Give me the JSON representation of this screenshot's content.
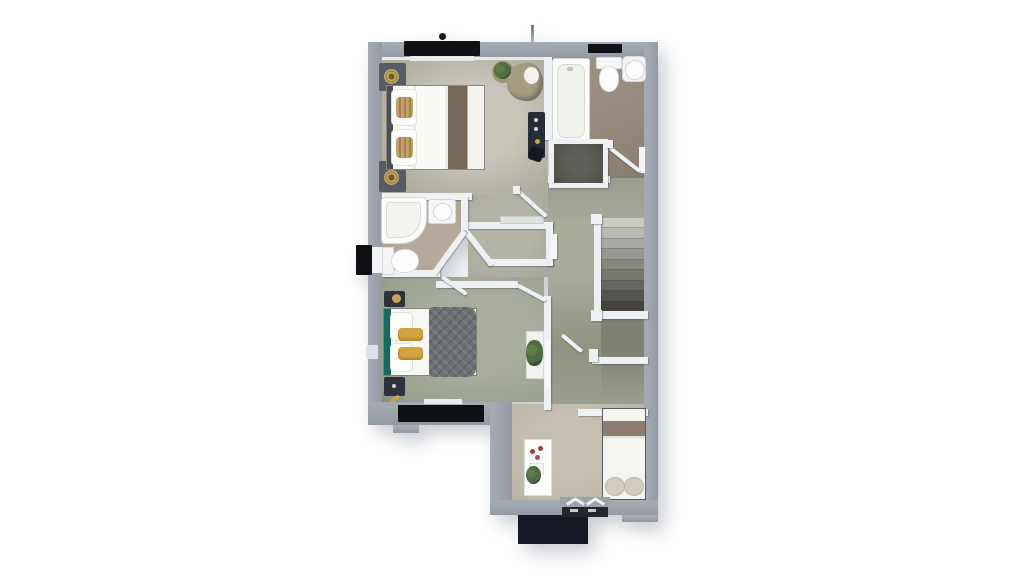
{
  "scene": {
    "type": "3d-floor-plan-render",
    "view": "top-down",
    "background": "#ffffff"
  },
  "palette": {
    "wallOuter": "#949aa3",
    "wallOuterLight": "#a7acb4",
    "wallInner": "#eef1f4",
    "windowBlack": "#0e1013",
    "porch": "#141924",
    "floorMaster": "#aeab9f",
    "floorMasterLight": "#c9c6bb",
    "floorBath": "#958a7b",
    "floorEnsuite": "#a89d8d",
    "floorHall": "#a6a79b",
    "floorHallDark": "#7d8073",
    "floorBed2": "#98a08f",
    "floorBed3": "#b9b3a5",
    "showerDark": "#4e4e49",
    "stairLight": "#cbcac3",
    "stairDark": "#45433d",
    "furnDark": "#2d323c",
    "tealHeadboard": "#156b62",
    "yellowPillow": "#d4a33c",
    "duvetGray": "#6d7174",
    "throwBrown": "#77675a",
    "oliveChair": "#a49d82",
    "gold": "#c9a34e",
    "bed3Stripe": "#8d7d6e",
    "plantGreen": "#4e6b43"
  },
  "stairs": {
    "tread_count": 9,
    "direction": "descending",
    "banister": true
  },
  "rooms": {
    "master_bedroom": {
      "position": "top-left",
      "items": [
        "double-bed",
        "white-linen",
        "brown-throw",
        "gold-cushions",
        "nightstand-with-lamp",
        "nightstand-with-lamp",
        "armchair",
        "potted-plant",
        "tall-dresser",
        "handbag"
      ]
    },
    "family_bathroom": {
      "position": "top-right",
      "items": [
        "bathtub",
        "toilet",
        "round-washbasin",
        "shower-enclosure",
        "radiator",
        "open-door"
      ]
    },
    "ensuite_shower_room": {
      "position": "middle-left",
      "items": [
        "shower-tray",
        "washbasin",
        "toilet",
        "window"
      ]
    },
    "bedroom_two": {
      "position": "bottom-left",
      "items": [
        "double-bed-teal-headboard",
        "yellow-pillows",
        "gray-quilted-duvet",
        "nightstand-with-lamp",
        "nightstand-with-lamp",
        "plant-shelf"
      ]
    },
    "landing_hallway": {
      "position": "center",
      "items": [
        "airing-cupboard",
        "radiator",
        "door-leaves",
        "stair-railing"
      ]
    },
    "bedroom_three": {
      "position": "bottom-right",
      "items": [
        "single-bed",
        "tan-stripe-blanket",
        "pillows",
        "white-desk-shelf",
        "decor-items",
        "potted-plant"
      ]
    }
  },
  "exterior": {
    "features": [
      "top-window-band-large",
      "top-window-band-small",
      "left-wall-window",
      "rear-window-band",
      "bay-window-chevron-trim",
      "porch-canopy",
      "roof-vent-dot",
      "roof-aerial"
    ]
  }
}
